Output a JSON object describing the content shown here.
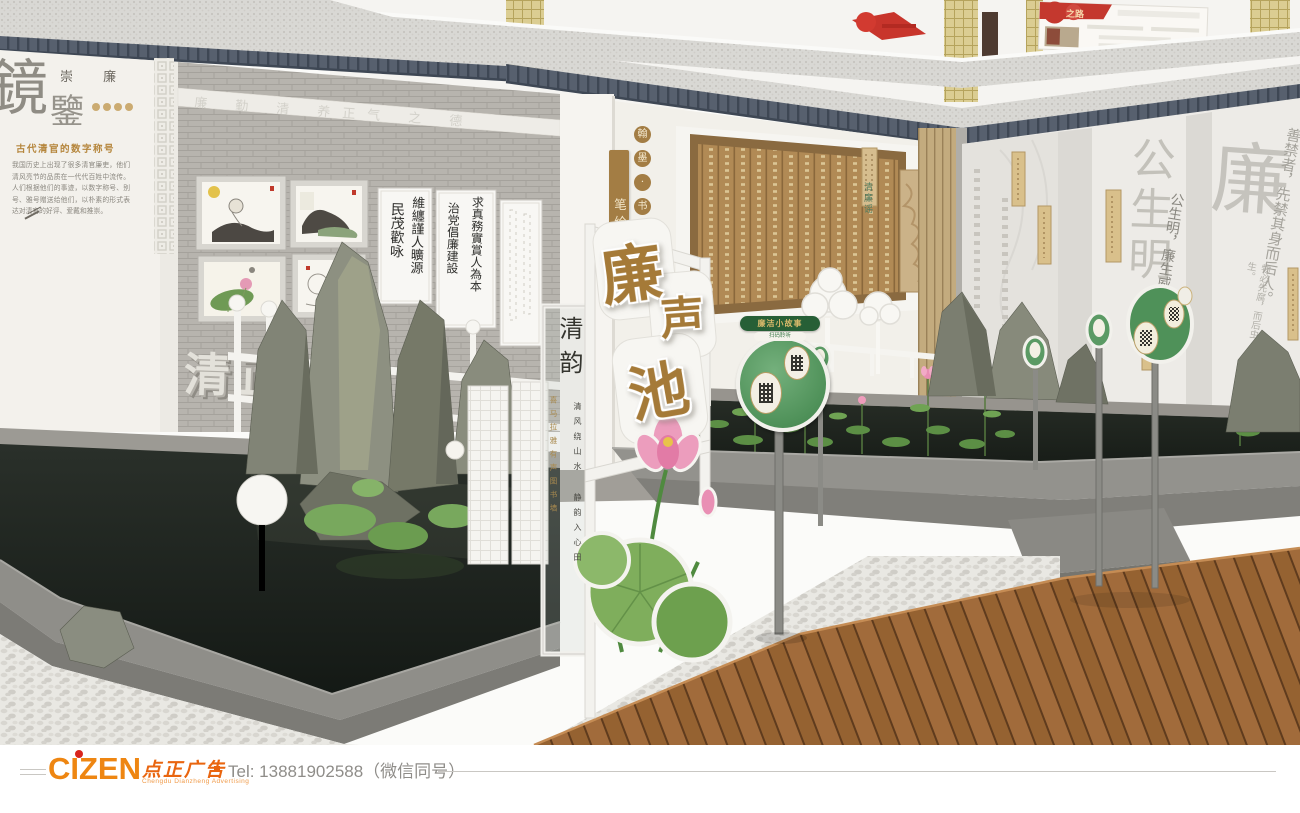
{
  "upper_floor": {
    "red_board_title": "之路"
  },
  "left_wall": {
    "char_jing": "鏡",
    "char_jian": "鑒",
    "subtitle": "崇 廉",
    "heading": "古代清官的数字称号",
    "paragraph": "我国历史上出现了很多清官廉吏，他们清风亮节的品质在一代代百姓中流传。人们根据他们的事迹，以数字称号、别号、雅号赠送给他们，以朴素的形式表达对清官的好评、爱戴和推崇。",
    "frieze": "廉 勤 清 养正气 之 德",
    "wall_3d_left": "清正",
    "wall_3d_right": "廉"
  },
  "scrolls": {
    "s1_col1": "民茂歡咏",
    "s1_col2": "維纏謹人曠源",
    "s2_col1": "求真務實賞人為本",
    "s2_col2": "治党倡廉建設"
  },
  "center_wall": {
    "strip_circles": [
      "翰",
      "墨",
      "·",
      "书"
    ],
    "strip_vertical": "笔绘清廉",
    "panel_title": "清廉谣"
  },
  "pond_sign": {
    "char_1": "廉",
    "char_2": "声",
    "char_3": "池"
  },
  "glass_panel": {
    "title": "清韵",
    "gold_column": "喜马拉雅有声图书墙",
    "black_column": "清风绕山水 静韵入心田"
  },
  "right_wall": {
    "watermark_main": "公生明",
    "watermark_lian": "廉",
    "quote_1": "公生明，廉生威。",
    "quote_2": "善禁者，先禁其身而后人。",
    "quote_3": "物必先腐，而后虫生。"
  },
  "qr_sign": {
    "banner": "廉洁小故事",
    "pill": "扫码聆听"
  },
  "footer": {
    "logo_text": "CIZEN",
    "logo_cn": "点正广告",
    "logo_sub": "Chengdu Dianzheng Advertising",
    "tel": "Tel: 13881902588（微信同号）"
  }
}
